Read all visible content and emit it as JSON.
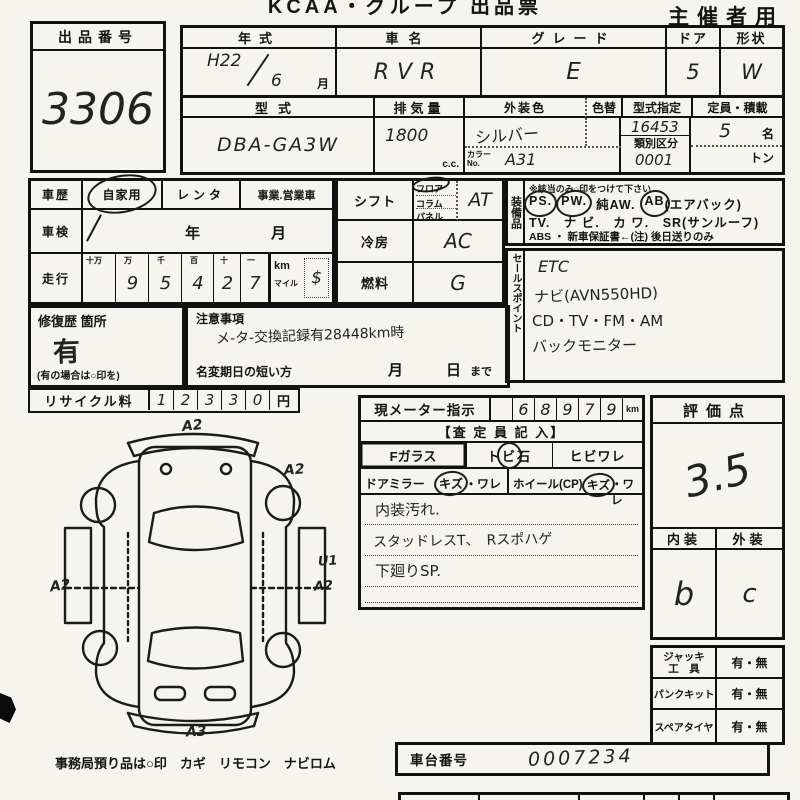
{
  "header": {
    "title": "KCAA・グループ 出品票",
    "corner": "主催者用"
  },
  "lot": {
    "label": "出品番号",
    "number": "3306"
  },
  "spec": {
    "year_label": "年式",
    "year_era": "H22",
    "year_month": "6",
    "month_suffix": "月",
    "name_label": "車名",
    "name_value": "RVR",
    "grade_label": "グレード",
    "grade_value": "E",
    "door_label": "ドア",
    "door_value": "5",
    "shape_label": "形状",
    "shape_value": "W",
    "model_label": "型式",
    "model_value": "DBA-GA3W",
    "disp_label": "排気量",
    "disp_value": "1800",
    "disp_unit": "c.c.",
    "color_label": "外装色",
    "color_value": "シルバー",
    "colorchg_label": "色替",
    "colorno_label": "カラーNo.",
    "colorno_value": "A31",
    "kata_label": "型式指定",
    "kata_value": "16453",
    "ruibetsu_label": "類別区分",
    "ruibetsu_value": "0001",
    "teiin_label": "定員・積載",
    "teiin_value": "5",
    "teiin_unit": "名",
    "ton_unit": "トン"
  },
  "history": {
    "label": "車歴",
    "private": "自家用",
    "rental": "レンタ",
    "business": "事業.営業車"
  },
  "shaken": {
    "label": "車検",
    "year_unit": "年",
    "month_unit": "月"
  },
  "mileage": {
    "label": "走行",
    "cols": [
      "十万",
      "万",
      "千",
      "百",
      "十",
      "一"
    ],
    "digits": [
      "",
      "9",
      "5",
      "4",
      "2",
      "7"
    ],
    "unit_km": "km",
    "unit_mile": "マイル",
    "mark": "$"
  },
  "shift": {
    "label": "シフト",
    "floor": "フロア",
    "column": "コラム",
    "panel": "パネル",
    "value": "AT"
  },
  "cooling": {
    "label": "冷房",
    "value": "AC"
  },
  "fuel": {
    "label": "燃料",
    "value": "G"
  },
  "equipment": {
    "label": "装備品",
    "note": "※該当のみ○印をつけて下さい",
    "l1": [
      "PS.",
      "PW.",
      "純AW.",
      "AB",
      "(エアバック)"
    ],
    "l2": "TV.　ナ ビ.　カ ワ.　SR(サンルーフ)",
    "l3": "ABS ・ 新車保証書←(注) 後日送りのみ"
  },
  "sales": {
    "label": "セールスポイント",
    "lines": [
      "ETC",
      "ナビ(AVN550HD)",
      "CD・TV・FM・AM",
      "バックモニター"
    ]
  },
  "repair": {
    "label": "修復歴 箇所",
    "value": "有",
    "note": "(有の場合は○印を)"
  },
  "caution": {
    "label": "注意事項",
    "text": "メ-タ-交換記録有28448km時",
    "namechange": "名変期日の短い方",
    "month": "月",
    "day": "日",
    "made": "まで"
  },
  "recycle": {
    "label": "リサイクル料",
    "digits": [
      "1",
      "2",
      "3",
      "3",
      "0"
    ],
    "unit": "円"
  },
  "meter": {
    "label": "現メーター指示",
    "digits": [
      "",
      "6",
      "8",
      "9",
      "7",
      "9"
    ],
    "unit": "km"
  },
  "assessor": {
    "header": "【査 定 員 記 入】",
    "fglass": "Fガラス",
    "tobi_pre": "ト",
    "tobi_mid": "ビ",
    "tobi_post": "石",
    "hibi": "ヒビワレ",
    "mirror": "ドアミラー",
    "mirror_kizu": "キズ",
    "mirror_ware": "・ワレ",
    "wheel": "ホイール(CP)",
    "wheel_kizu": "キズ",
    "wheel_ware": "・ワレ",
    "notes": [
      "内装汚れ.",
      "スタッドレスT、　Rスポハゲ",
      "下廻りSP."
    ]
  },
  "score": {
    "header": "評価点",
    "value": "3.5",
    "interior_label": "内装",
    "exterior_label": "外装",
    "interior": "b",
    "exterior": "c"
  },
  "accessories": {
    "rows": [
      {
        "label": "ジャッキ\n工　具",
        "value": "有・無"
      },
      {
        "label": "パンクキット",
        "value": "有・無"
      },
      {
        "label": "スペアタイヤ",
        "value": "有・無"
      }
    ]
  },
  "chassis": {
    "label": "車台番号",
    "value": "0007234"
  },
  "office": {
    "note": "事務局預り品は○印　カギ　リモコン　ナビロム"
  },
  "diagram": {
    "annotations": [
      "A2",
      "A2",
      "A2",
      "U1",
      "A2",
      "A3"
    ]
  }
}
